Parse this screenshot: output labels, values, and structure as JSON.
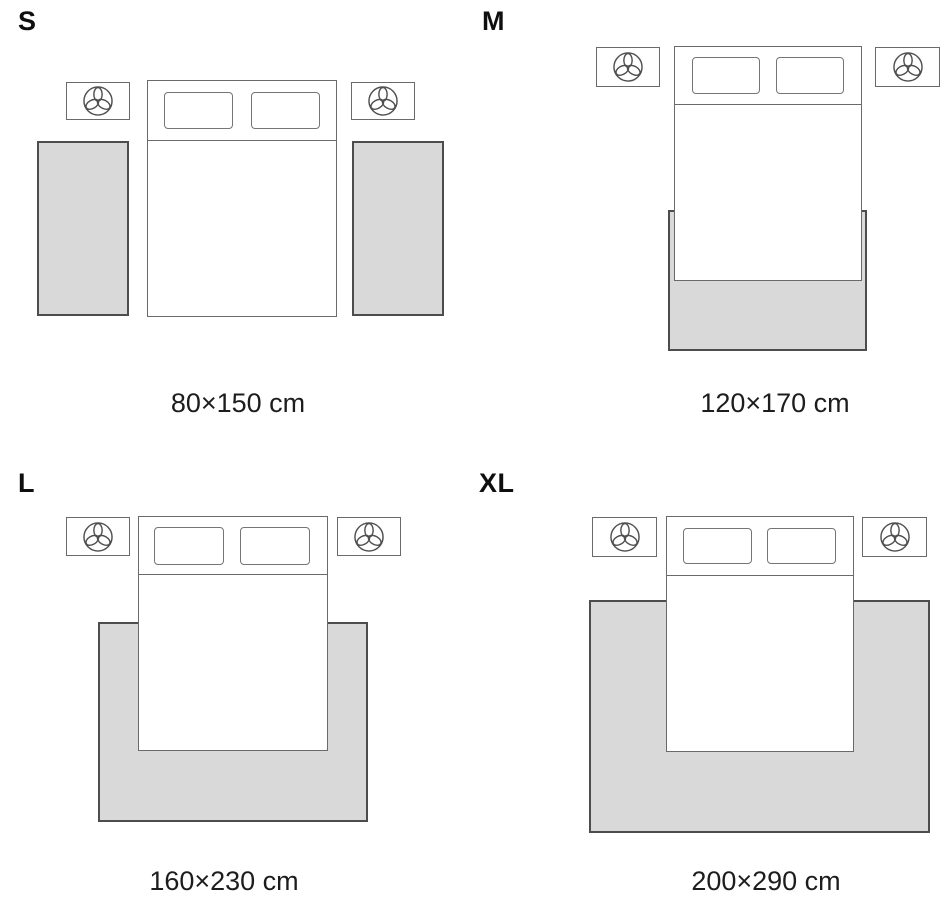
{
  "diagram": {
    "type": "rug-size-guide",
    "scene": "top-down bedroom plan: double bed with two pillows, two nightstands each decorated with a trefoil plant icon, light gray rug placement shown per size",
    "background": "#ffffff"
  },
  "colors": {
    "rug_fill": "#d9d9d9",
    "rug_border": "#4d4d4d",
    "furniture_line": "#6a6a6a",
    "text": "#1d1d1d"
  },
  "icons": {
    "nightstand_decor": "trefoil-plant-icon"
  },
  "sizes": [
    {
      "label": "S",
      "dimensions": "80×150 cm",
      "rug_placement": "two runner rugs, one on each side of the bed"
    },
    {
      "label": "M",
      "dimensions": "120×170 cm",
      "rug_placement": "one rug under the foot of the bed"
    },
    {
      "label": "L",
      "dimensions": "160×230 cm",
      "rug_placement": "one rug under the lower part of the bed, extending on both sides"
    },
    {
      "label": "XL",
      "dimensions": "200×290 cm",
      "rug_placement": "one large rug spanning the full bed width out to the nightstand edges"
    }
  ]
}
